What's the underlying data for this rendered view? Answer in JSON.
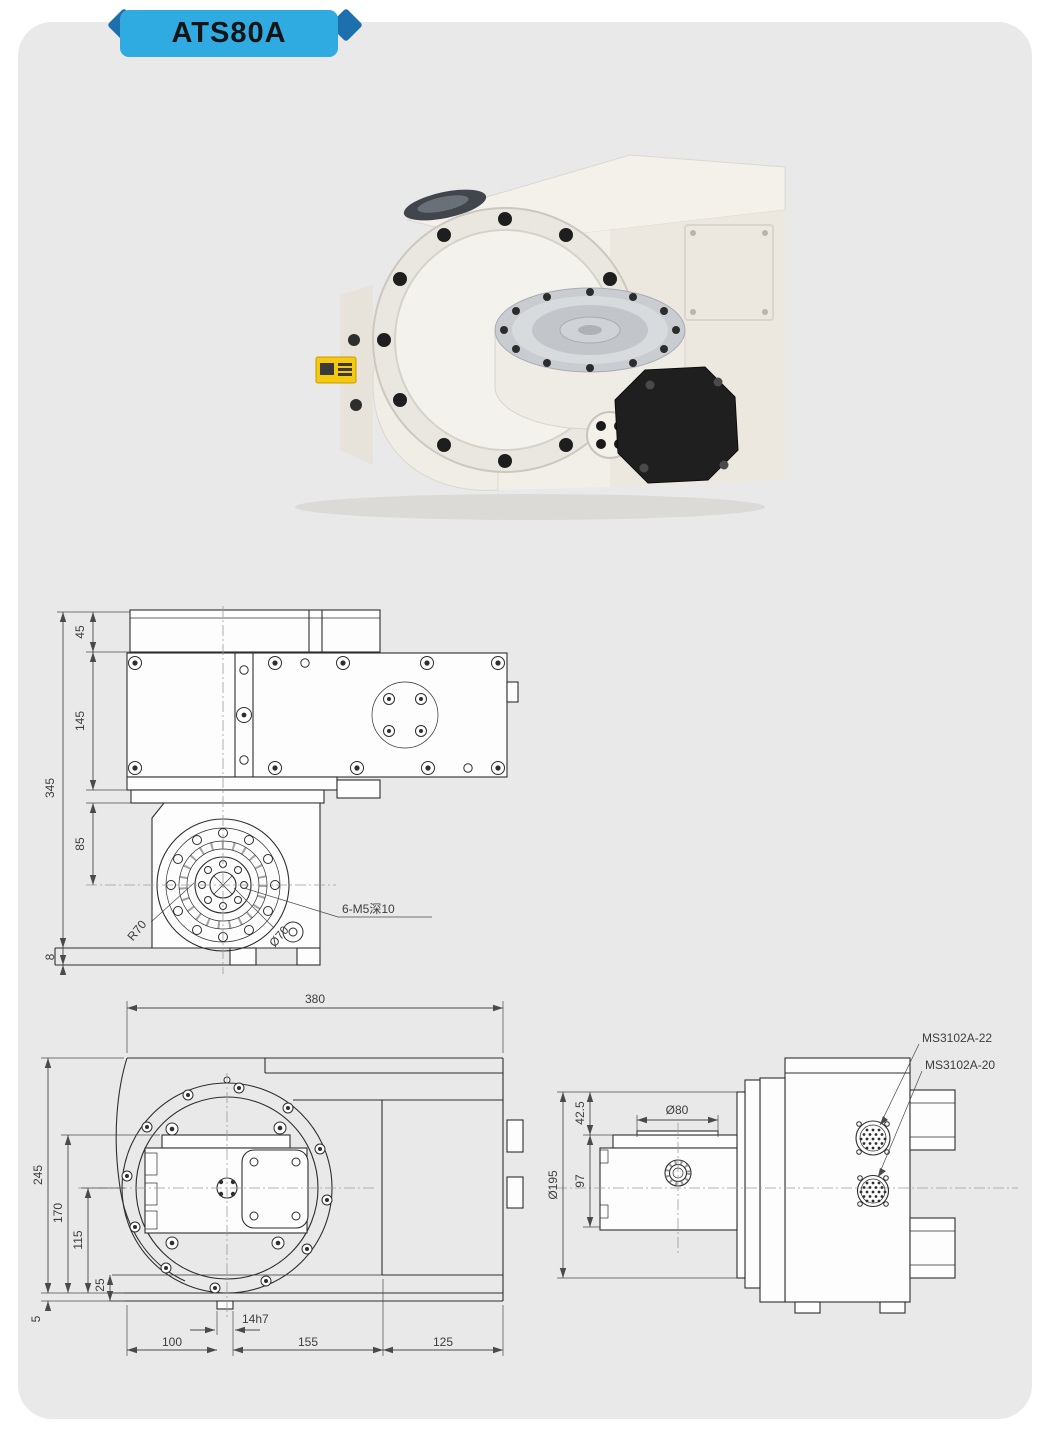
{
  "header": {
    "model": "ATS80A"
  },
  "colors": {
    "badge": "#2fabe2",
    "badge_fold": "#1d6fae",
    "panel_background": "#e9e9ea",
    "drawing_line": "#2e2e2e",
    "machine_body": "#f1eee8",
    "cover_black": "#1f1f1f",
    "warning_label": "#f6c80e"
  },
  "drawings": {
    "top_view": {
      "dim_45": "45",
      "dim_145": "145",
      "dim_345": "345",
      "dim_85": "85",
      "dim_8": "8",
      "label_r70": "R70",
      "label_dia70": "Ø70",
      "label_thread": "6-M5深10"
    },
    "front_view": {
      "dim_380": "380",
      "dim_245": "245",
      "dim_170": "170",
      "dim_115": "115",
      "dim_25": "25",
      "dim_5": "5",
      "dim_100": "100",
      "dim_key": "14h7",
      "dim_155": "155",
      "dim_125": "125"
    },
    "side_view": {
      "dim_dia195": "Ø195",
      "dim_42_5": "42.5",
      "dim_97": "97",
      "dim_dia80": "Ø80",
      "label_conn_upper": "MS3102A-22",
      "label_conn_lower": "MS3102A-20"
    }
  }
}
